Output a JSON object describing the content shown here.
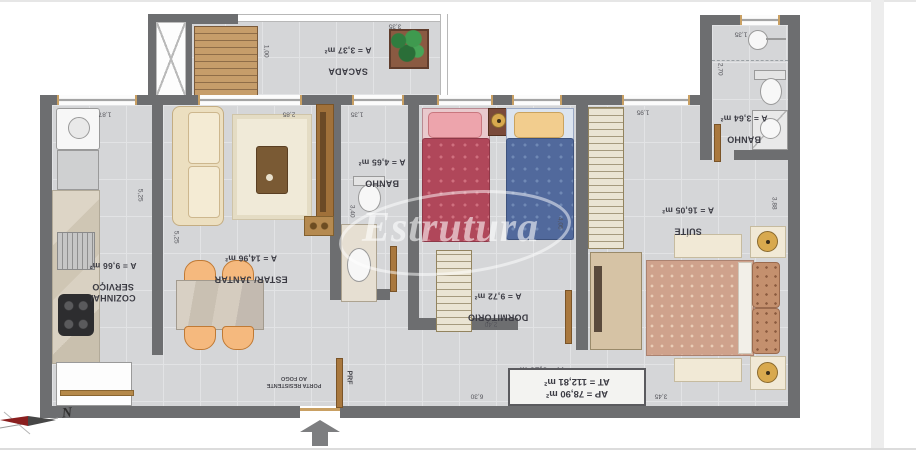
{
  "plan": {
    "watermark": "Estrutura",
    "compass_label": "N",
    "rooms": [
      {
        "name": "SACADA",
        "area": "A = 3,37 m²"
      },
      {
        "name": "COZINHA/\nSERVIÇO",
        "area": "A = 9,66 m²"
      },
      {
        "name": "ESTAR/ JANTAR",
        "area": "A = 14,96 m²"
      },
      {
        "name": "BANHO",
        "area": "A = 4,65 m²"
      },
      {
        "name": "DORMITÓRIO",
        "area": "A = 9,72 m²"
      },
      {
        "name": "BANHO",
        "area": "A = 3,64 m²"
      },
      {
        "name": "SUÍTE",
        "area": "A = 16,05 m²"
      },
      {
        "name": "CIRC.",
        "area": "A = 5,15 m²"
      }
    ],
    "summary": {
      "ap": "AP = 78,90 m²",
      "at": "AT = 112,81 m²"
    },
    "fire_door": {
      "label": "PORTA RESISTENTE\nAO FOGO",
      "tag": "PRF"
    },
    "dimensions": [
      "3,35",
      "1,00",
      "1,35",
      "2,70",
      "1,87",
      "2,85",
      "1,35",
      "1,95",
      "5,25",
      "5,25",
      "3,40",
      "4,05",
      "3,88",
      "2,40",
      "6,30",
      "3,45"
    ],
    "colors": {
      "wall": "#6d6e70",
      "floor": "#d5d6d8",
      "wood": "#a9783e",
      "bed_red": "#b0475a",
      "bed_blue": "#51699c",
      "suite_bed": "#cfa28c"
    }
  }
}
